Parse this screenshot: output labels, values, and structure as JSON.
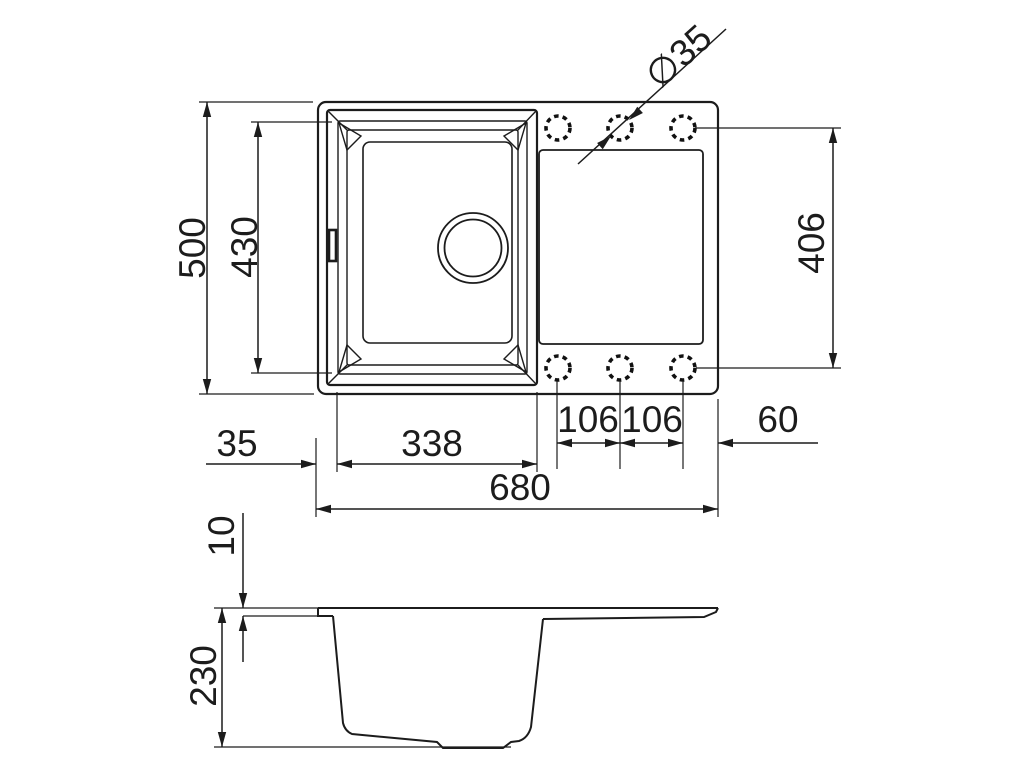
{
  "drawing": {
    "description": "Technical dimension drawing of a kitchen sink with single bowl and drainboard, top view and side section view",
    "units": "mm"
  },
  "dims": {
    "overall_depth": "500",
    "bowl_depth": "430",
    "hole_diameter": "∅35",
    "hole_row_span": "406",
    "left_edge_offset": "35",
    "bowl_width": "338",
    "hole_spacing_a": "106",
    "hole_spacing_b": "106",
    "right_hole_offset": "60",
    "overall_width": "680",
    "rim_thickness": "10",
    "bowl_height": "230"
  },
  "colors": {
    "line": "#1c1c1c",
    "background": "#ffffff"
  }
}
